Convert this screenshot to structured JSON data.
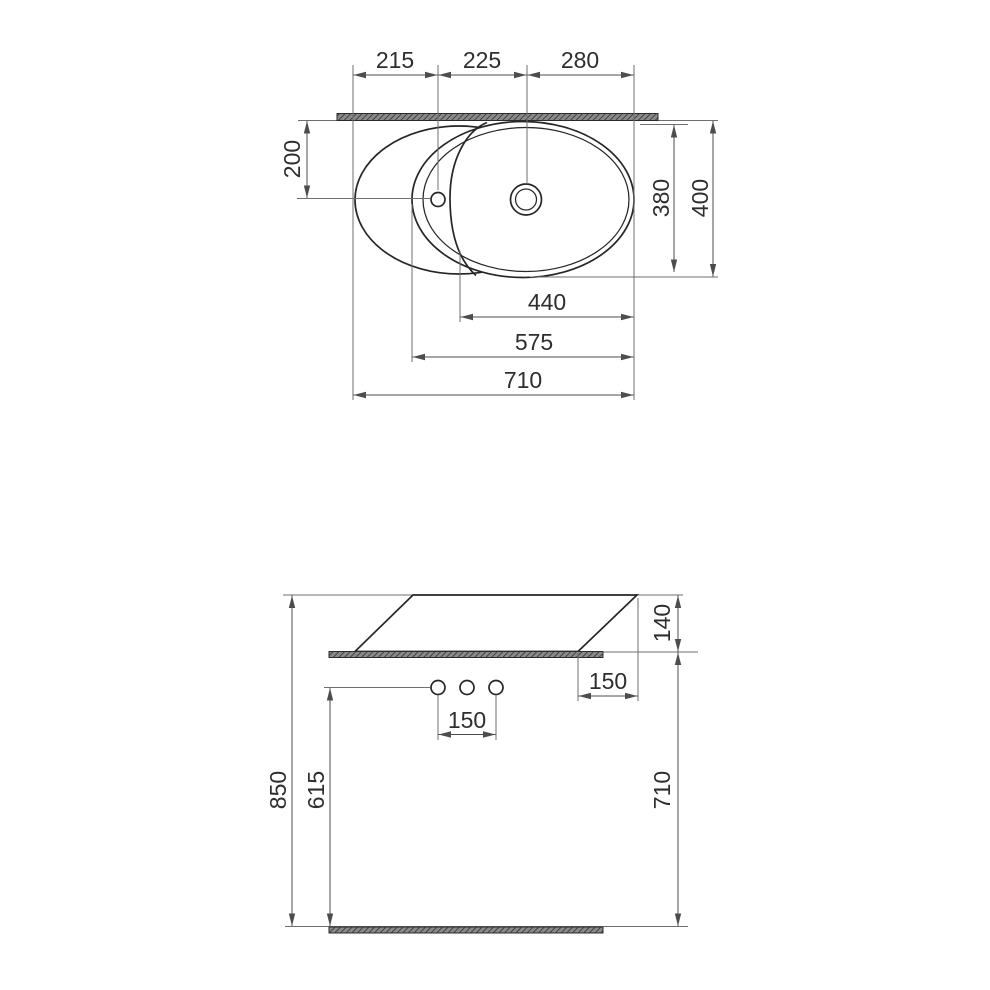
{
  "colors": {
    "object_line": "#262626",
    "dimension_line": "#4d4d4d",
    "extension_line": "#6f6f6f",
    "text_color": "#2e2e2e",
    "hatch_fill": "#8a8a8a",
    "hatch_line": "#2b2b2b"
  },
  "top_view": {
    "dims": {
      "left_to_faucet": "215",
      "faucet_to_drain": "225",
      "drain_to_right": "280",
      "front_to_holes": "200",
      "bowl_depth": "380",
      "overall_depth": "400",
      "bowl_inner_width": "440",
      "bowl_width": "575",
      "overall_width": "710"
    }
  },
  "front_view": {
    "dims": {
      "basin_height": "140",
      "counter_overhang": "150",
      "faucet_hole_spacing": "150",
      "counter_top_height": "850",
      "supply_height": "615",
      "under_counter_clearance": "710"
    }
  }
}
